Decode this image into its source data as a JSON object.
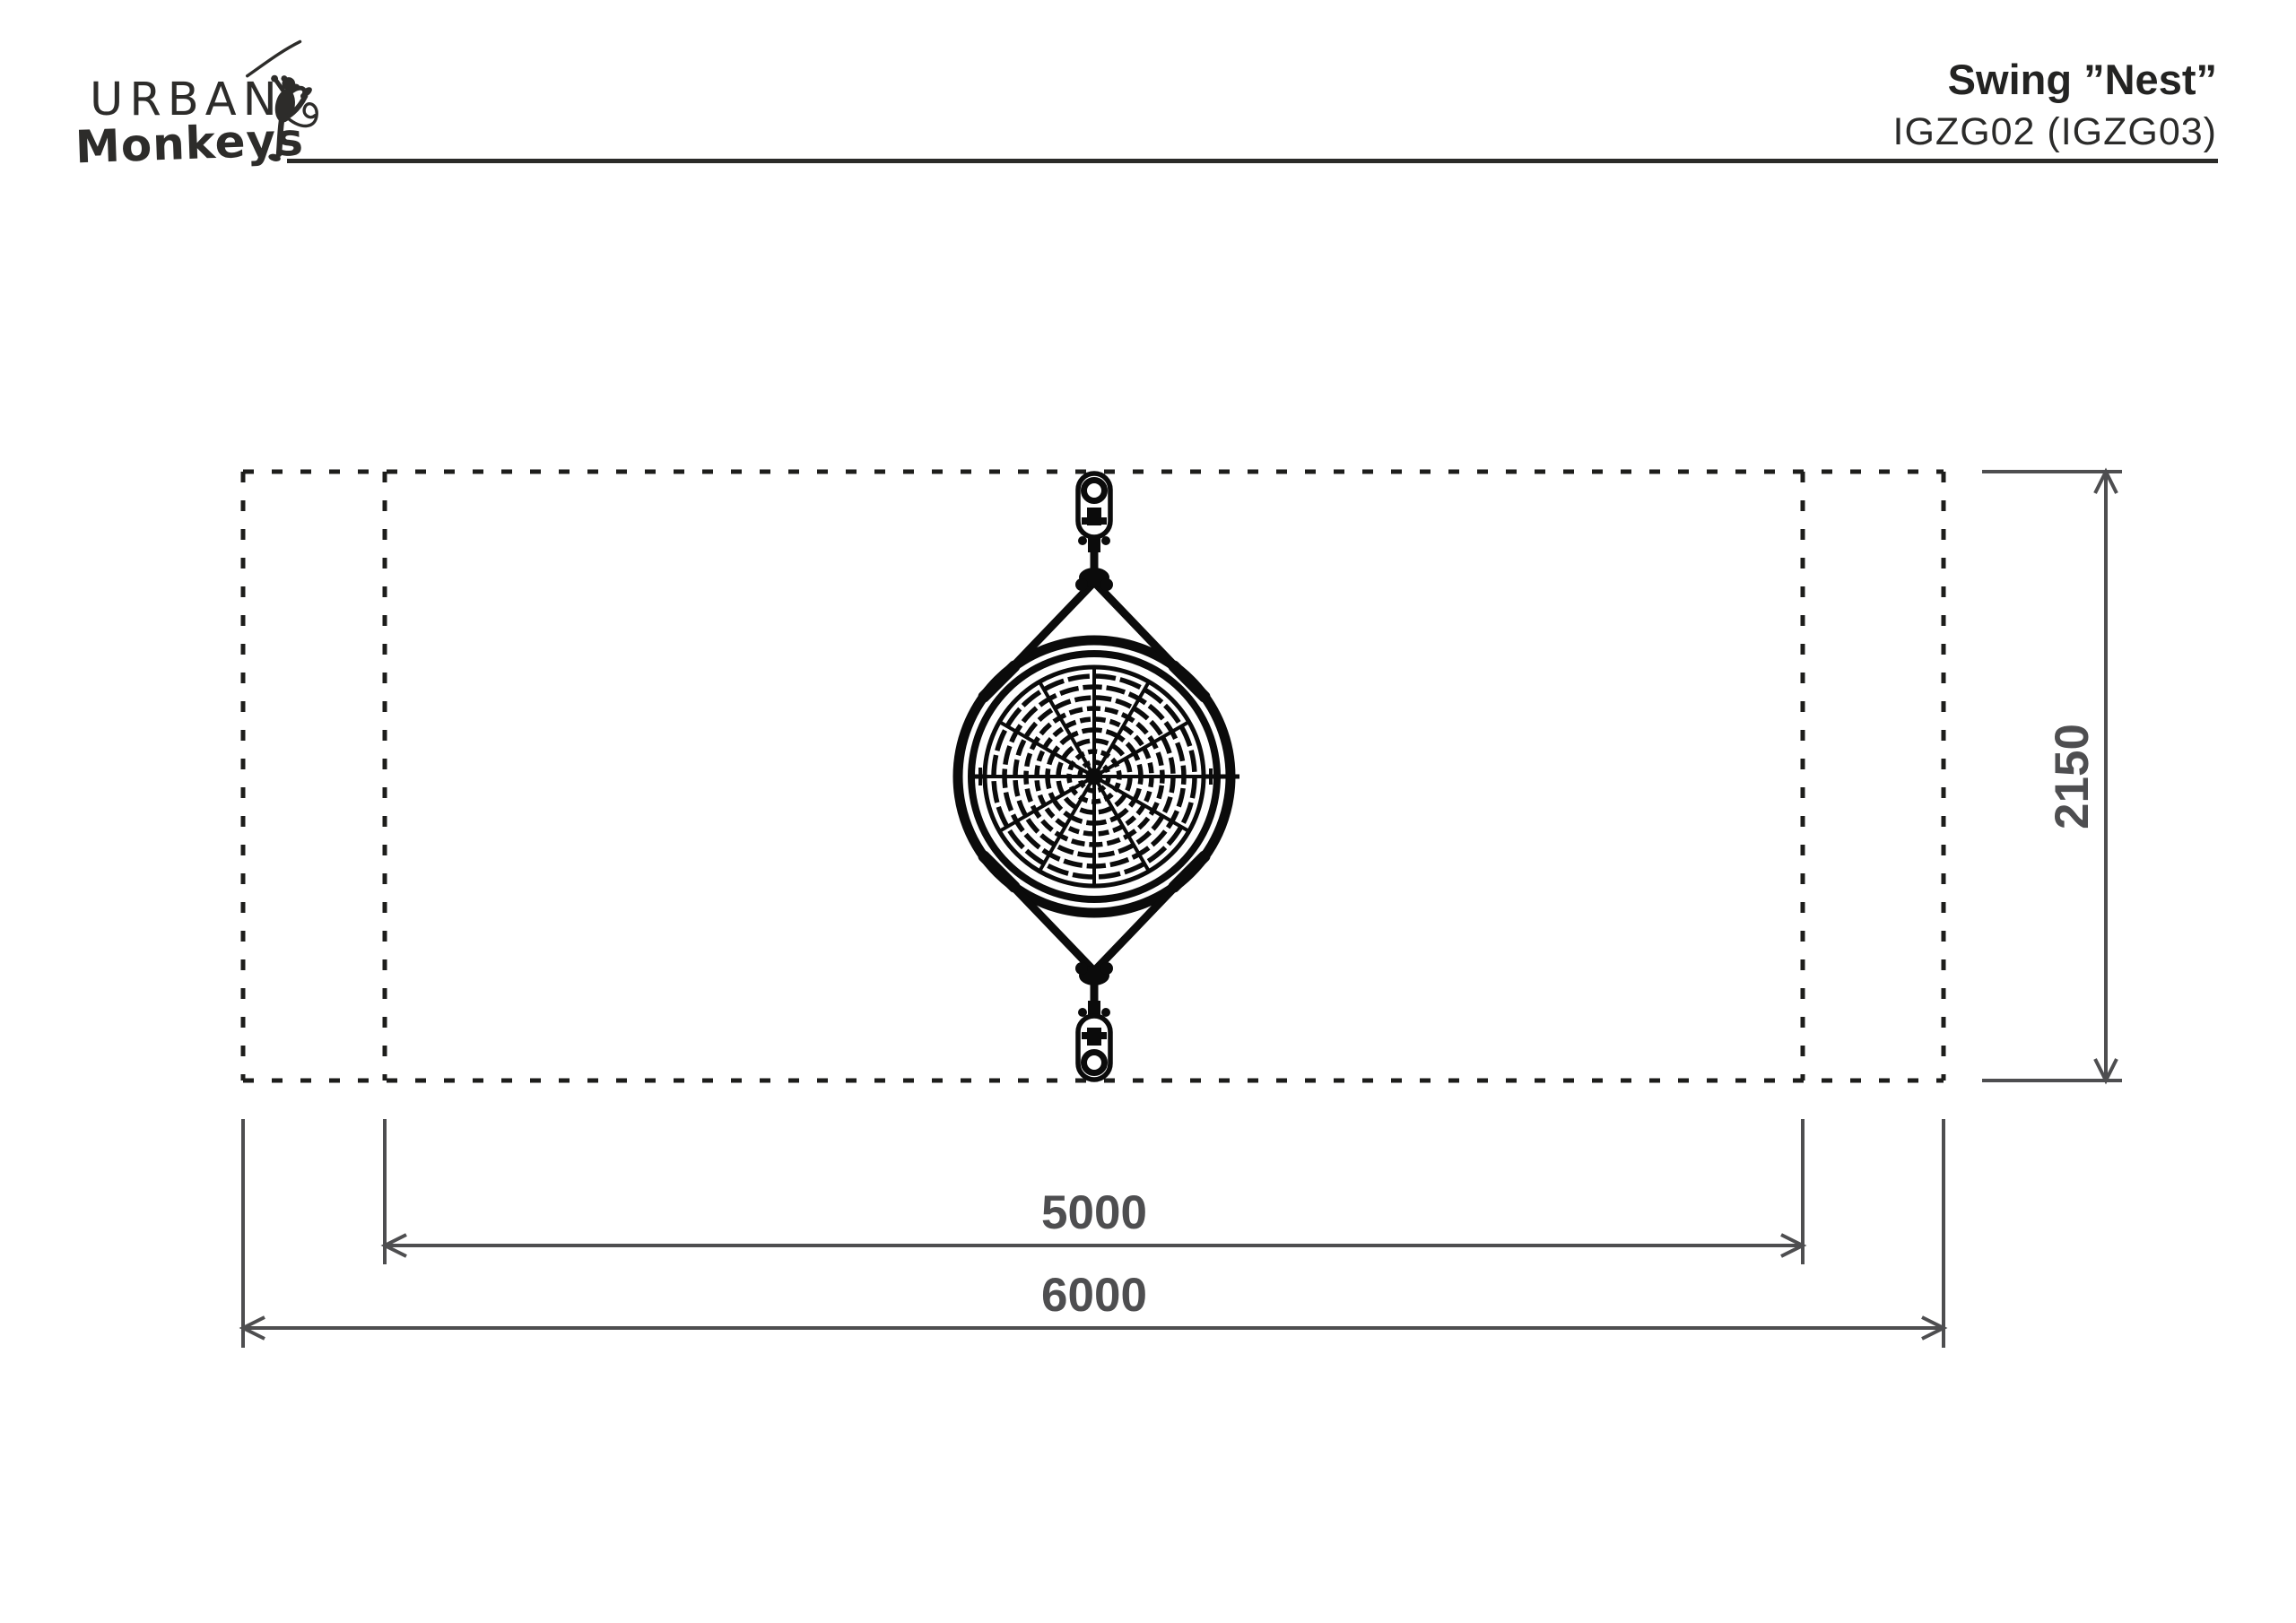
{
  "header": {
    "logo": {
      "line1": "URBAN",
      "line2": "Monkeys"
    },
    "product": {
      "title": "Swing ”Nest”",
      "code": "IGZG02 (IGZG03)"
    }
  },
  "drawing": {
    "subject": "nest swing top view with safety zone",
    "dimensions": {
      "inner_width_mm": "5000",
      "outer_width_mm": "6000",
      "depth_mm": "2150"
    }
  },
  "colors": {
    "background": "#ffffff",
    "drawing_ink": "#0b0b0b",
    "dotted_boundary": "#1d1d1b",
    "dimension_gray": "#4e4e50",
    "header_text": "#2d2c2a"
  }
}
